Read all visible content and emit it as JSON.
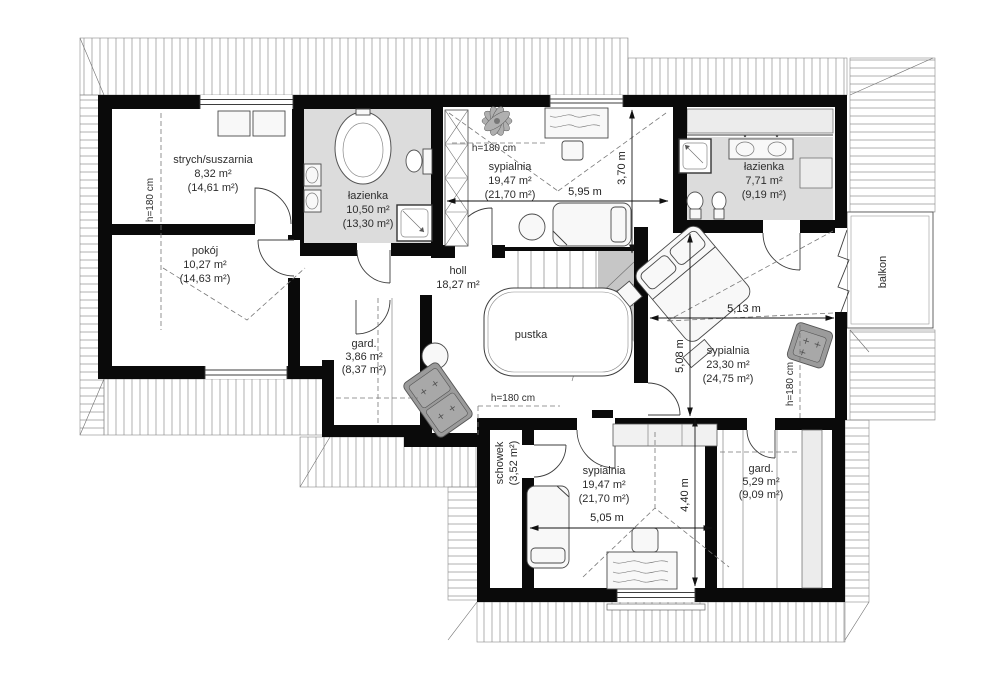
{
  "rooms": {
    "strych": {
      "name": "strych/suszarnia",
      "area": "8,32 m²",
      "total": "(14,61 m²)"
    },
    "pokoj": {
      "name": "pokój",
      "area": "10,27 m²",
      "total": "(14,63 m²)"
    },
    "lazienka_top": {
      "name": "łazienka",
      "area": "10,50 m²",
      "total": "(13,30 m²)"
    },
    "sypialnia_top": {
      "name": "sypialnia",
      "area": "19,47 m²",
      "total": "(21,70 m²)"
    },
    "lazienka_right": {
      "name": "łazienka",
      "area": "7,71 m²",
      "total": "(9,19 m²)"
    },
    "sypialnia_right": {
      "name": "sypialnia",
      "area": "23,30 m²",
      "total": "(24,75 m²)"
    },
    "sypialnia_bottom": {
      "name": "sypialnia",
      "area": "19,47 m²",
      "total": "(21,70 m²)"
    },
    "gard_small": {
      "name": "gard.",
      "area": "3,86 m²",
      "total": "(8,37 m²)"
    },
    "gard_large": {
      "name": "gard.",
      "area": "5,29 m²",
      "total": "(9,09 m²)"
    },
    "schowek": {
      "name": "schowek",
      "total": "(3,52 m²)"
    },
    "holl": {
      "name": "holl",
      "area": "18,27 m²"
    },
    "pustka": {
      "name": "pustka"
    },
    "balkon": {
      "name": "balkon"
    }
  },
  "dimensions": {
    "top_width": "5,95 m",
    "top_depth": "3,70 m",
    "right_width": "5,13 m",
    "right_depth": "5,08 m",
    "bottom_width": "5,05 m",
    "bottom_depth": "4,40 m"
  },
  "annotations": {
    "ceiling_height": "h=180 cm"
  },
  "colors": {
    "wall": "#0a0a0a",
    "bath_floor": "#dcdcdc",
    "upholstery": "#9b9b9b",
    "stair_shadow": "#c6c6c6"
  }
}
